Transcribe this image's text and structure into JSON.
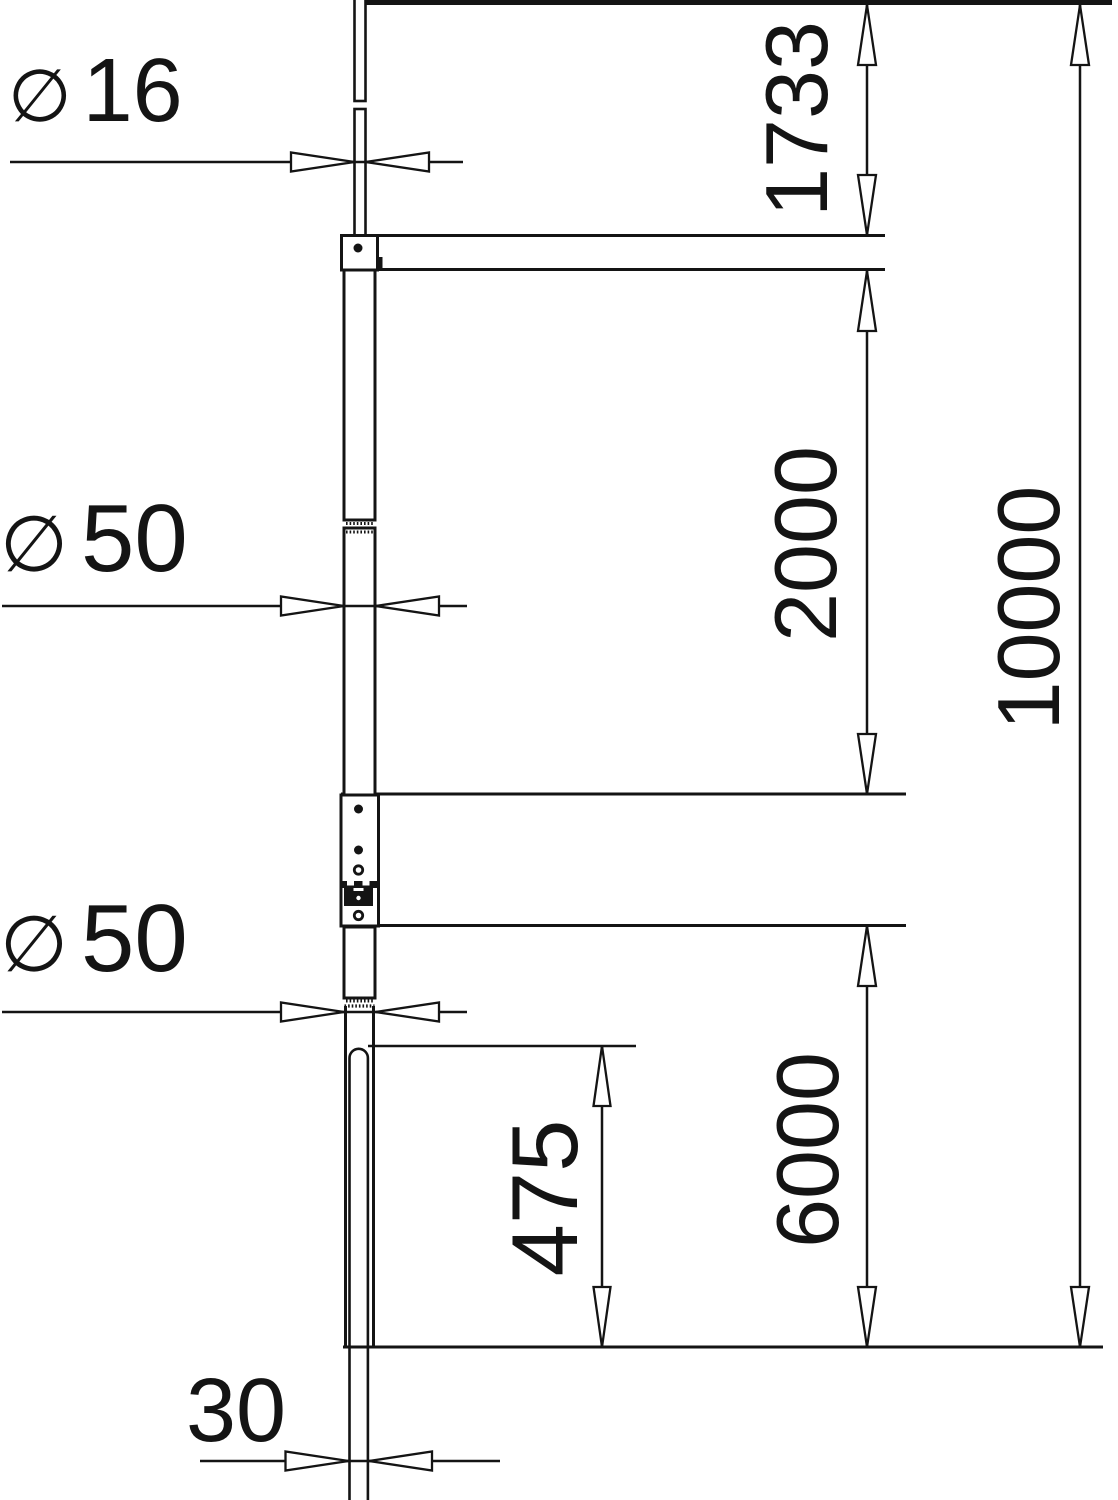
{
  "labels": {
    "rod_diameter": {
      "symbol": "∅",
      "value": "16"
    },
    "upper_tube_diameter": {
      "symbol": "∅",
      "value": "50"
    },
    "lower_tube_diameter": {
      "symbol": "∅",
      "value": "50"
    },
    "base_rod_width": {
      "value": "30"
    }
  },
  "dimensions": {
    "tip_section_height": "1733",
    "upper_tube_height": "2000",
    "lower_section_height": "6000",
    "total_height": "10000",
    "overlap_depth": "475"
  },
  "style": {
    "stroke_color": "#141414",
    "background": "#ffffff"
  }
}
